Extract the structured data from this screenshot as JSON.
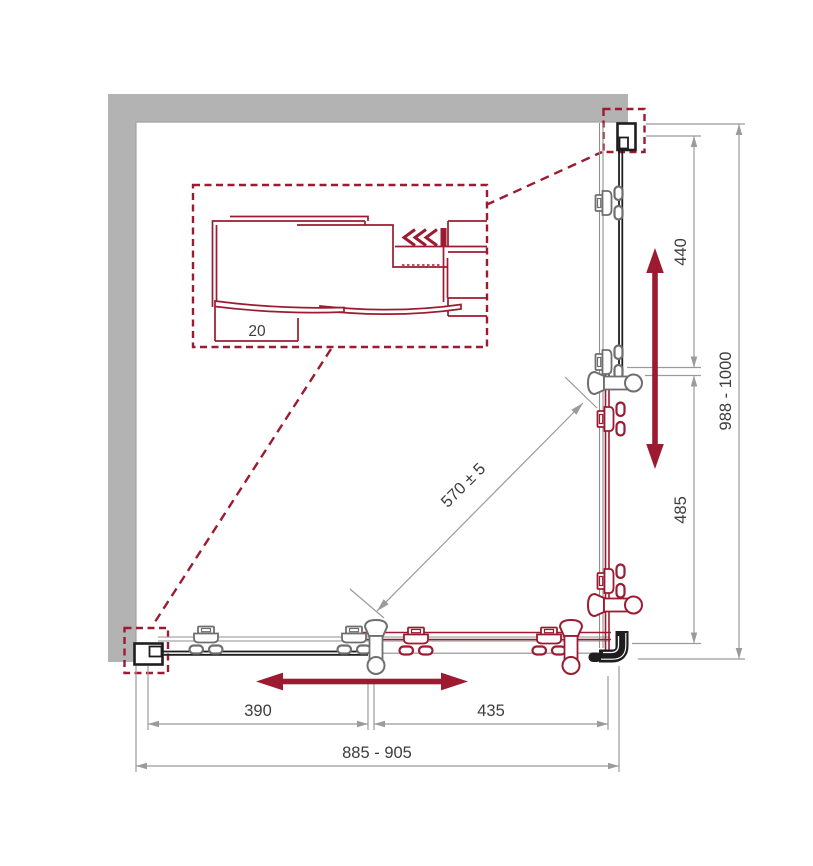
{
  "colors": {
    "accent_red": "#9c1b31",
    "wall_gray": "#b3b3b3",
    "wall_edge_gray": "#a2a2a2",
    "dimension_gray": "#9b9b9b",
    "track_gray": "#8f8f8f",
    "roller_gray": "#6f6f6f",
    "line_dark": "#1e1e1e",
    "text_dark": "#3d3d3d"
  },
  "dims": {
    "overall_width": "885 - 905",
    "overall_depth": "988 - 1000",
    "bottom_left": "390",
    "bottom_right": "435",
    "right_upper": "440",
    "right_lower": "485",
    "diagonal": "570 ± 5",
    "profile_detail": "20"
  }
}
